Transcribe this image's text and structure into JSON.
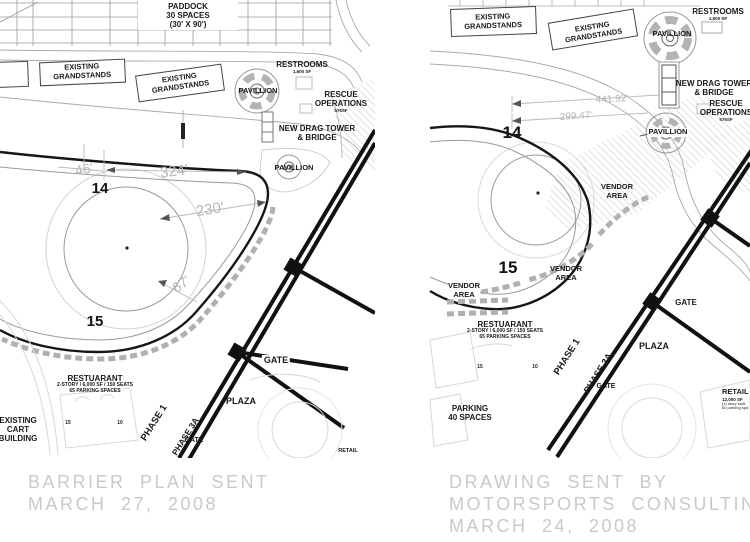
{
  "captions": {
    "left": [
      "BARRIER PLAN SENT",
      "MARCH 27, 2008"
    ],
    "right": [
      "DRAWING SENT BY",
      "MOTORSPORTS CONSULTING",
      "MARCH 24, 2008"
    ]
  },
  "left_plan": {
    "paddock_l1": "PADDOCK",
    "paddock_l2": "30 SPACES",
    "paddock_l3": "(30' X 90')",
    "grandstands_l1": "EXISTING",
    "grandstands_l2": "GRANDSTANDS",
    "restrooms": "RESTROOMS",
    "restrooms_sf": "1,600 SF",
    "pavillion": "PAVILLION",
    "pavillion2": "PAVILLION",
    "rescue_l1": "RESCUE",
    "rescue_l2": "OPERATIONS",
    "rescue_sf": "576SF",
    "drag_tower_l1": "NEW DRAG TOWER",
    "drag_tower_l2": "& BRIDGE",
    "dim_46": "46'",
    "dim_324": "324'",
    "dim_230": "230'",
    "dim_67": "67'",
    "turn_14": "14",
    "turn_15": "15",
    "restaurant": "RESTUARANT",
    "restaurant_l2": "2-STORY / 6,000 SF / 150 SEATS",
    "restaurant_l3": "65 PARKING SPACES",
    "cart_l1": "EXISTING",
    "cart_l2": "CART",
    "cart_l3": "BUILDING",
    "phase1": "PHASE 1",
    "phase3a": "PHASE 3A",
    "gate": "GATE",
    "gate2": "GATE",
    "plaza": "PLAZA",
    "retail": "RETAIL",
    "lot15": "15",
    "lot10": "10"
  },
  "right_plan": {
    "grandstands_l1": "EXISTING",
    "grandstands_l2": "GRANDSTANDS",
    "restrooms": "RESTROOMS",
    "restrooms_sf": "1,600 SF",
    "pavillion": "PAVILLION",
    "pavillion2": "PAVILLION",
    "drag_tower_l1": "NEW DRAG TOWER",
    "drag_tower_l2": "& BRIDGE",
    "rescue_l1": "RESCUE",
    "rescue_l2": "OPERATIONS",
    "rescue_sf": "576SF",
    "dim_441": "441.92'",
    "dim_299": "299.47'",
    "turn_14": "14",
    "turn_15": "15",
    "vendor_l1": "VENDOR",
    "vendor_l2": "AREA",
    "restaurant": "RESTUARANT",
    "restaurant_l2": "2-STORY / 6,000 SF / 150 SEATS",
    "restaurant_l3": "65 PARKING SPACES",
    "plaza": "PLAZA",
    "gate": "GATE",
    "gate2": "GATE",
    "phase1": "PHASE 1",
    "phase3a": "PHASE 3A",
    "parking_l1": "PARKING",
    "parking_l2": "40 SPACES",
    "retail": "RETAIL",
    "retail_sf": "12,000 SF",
    "retail_l3": "(1) story built",
    "retail_l4": "60 parking spa",
    "lot15": "15",
    "lot10": "10"
  }
}
